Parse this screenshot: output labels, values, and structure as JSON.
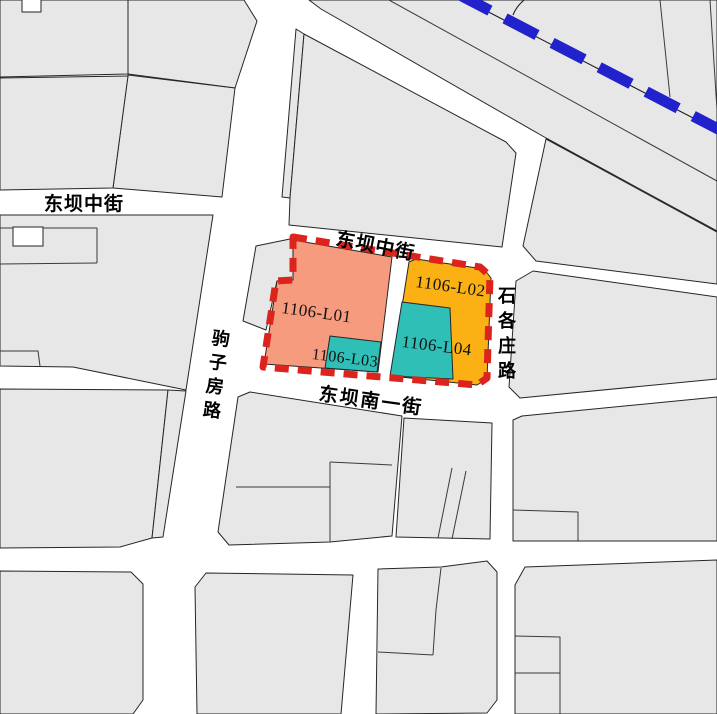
{
  "map": {
    "description": "Urban land-use parcel map with planning boundary",
    "parcels": {
      "l01": {
        "label": "1106-L01",
        "fill": "#F69B7D"
      },
      "l02": {
        "label": "1106-L02",
        "fill": "#FBB014"
      },
      "l03": {
        "label": "1106-L03",
        "fill": "#2FBFB6"
      },
      "l04": {
        "label": "1106-L04",
        "fill": "#2FBFB6"
      }
    },
    "streets": {
      "dongba_middle_west": {
        "name": "东坝中街",
        "orientation": "horizontal"
      },
      "dongba_middle_center": {
        "name": "东坝中街",
        "orientation": "diagonal"
      },
      "dongba_south_first": {
        "name": "东坝南一街",
        "orientation": "diagonal"
      },
      "juzifang_road": {
        "name": "驹子房路",
        "orientation": "vertical"
      },
      "shigezhuang_road": {
        "name": "石各庄路",
        "orientation": "vertical"
      }
    },
    "colors": {
      "boundary_red": "#DC231C",
      "railway_blue": "#2222CD",
      "parcel_gray": "#E7E7E7",
      "line_dark": "#262626",
      "background": "#FFFFFF"
    }
  }
}
